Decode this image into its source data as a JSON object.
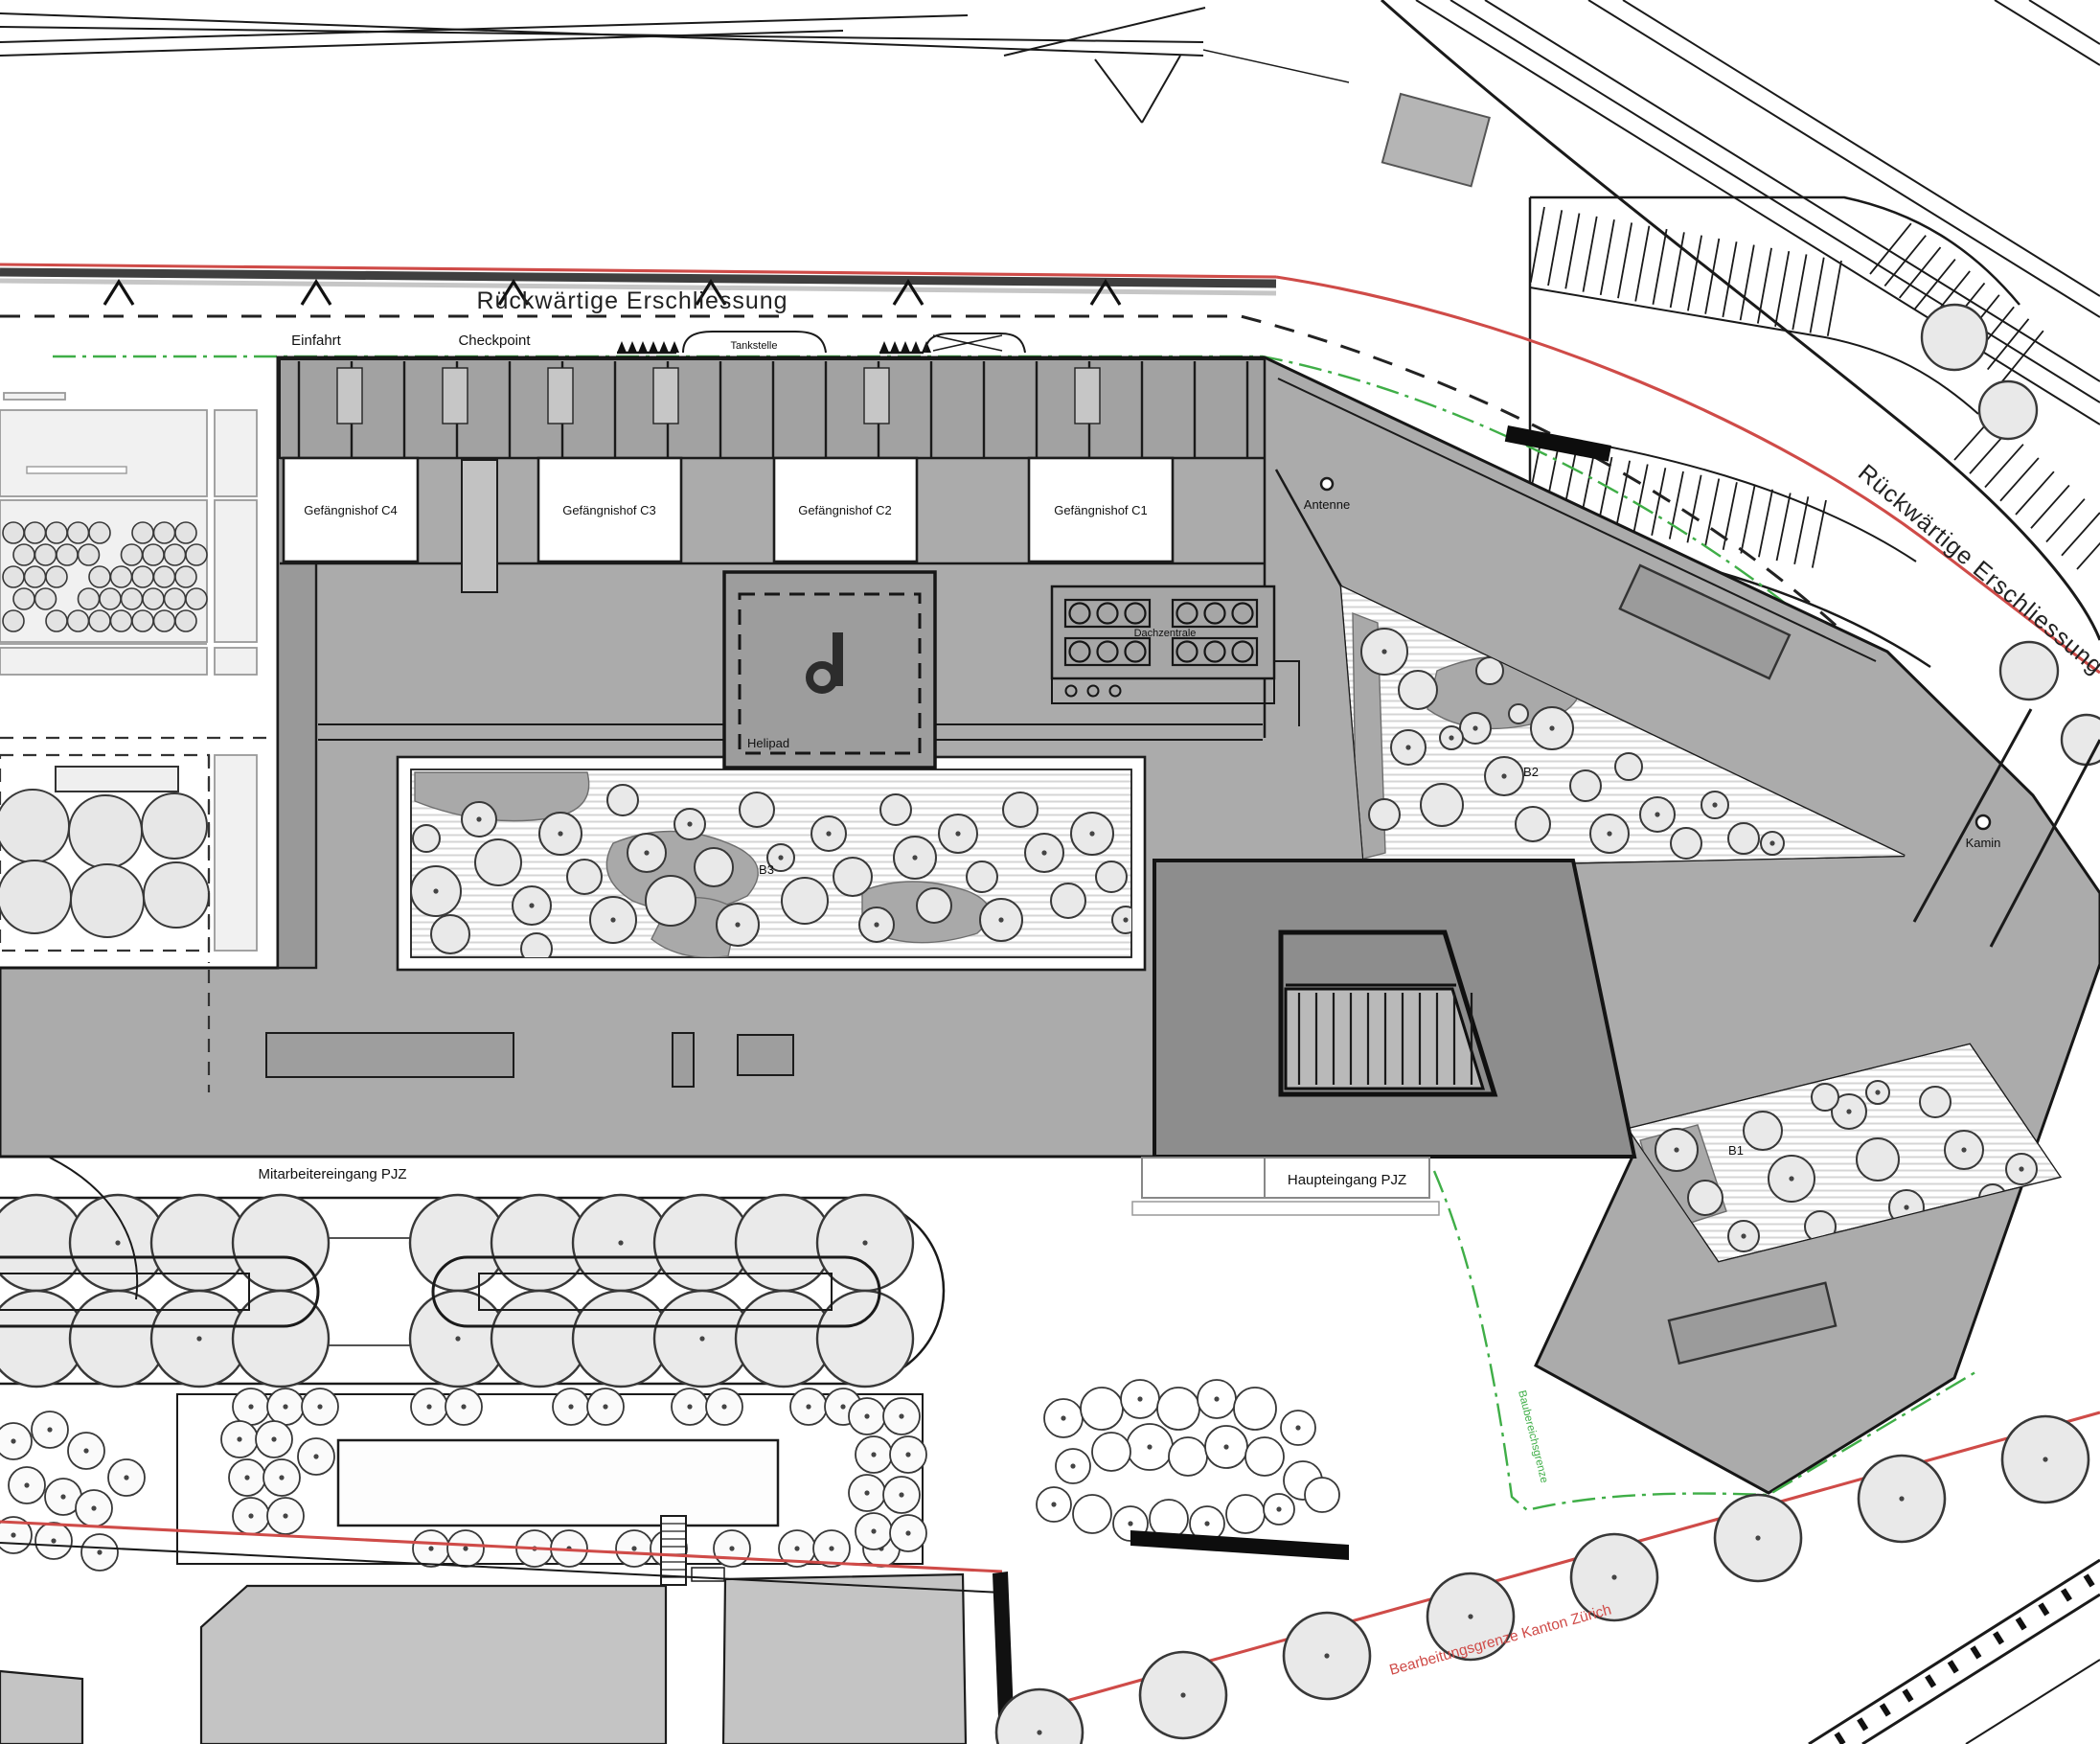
{
  "site_plan": {
    "roads": {
      "rear_access_top": "Rückwärtige Erschliessung",
      "rear_access_right": "Rückwärtige Erschliessung"
    },
    "access": {
      "einfahrt": "Einfahrt",
      "checkpoint": "Checkpoint",
      "tankstelle": "Tankstelle"
    },
    "prison_courtyards": {
      "c4": "Gefängnishof C4",
      "c3": "Gefängnishof C3",
      "c2": "Gefängnishof C2",
      "c1": "Gefängnishof C1"
    },
    "garden_courtyards": {
      "b1": "B1",
      "b2": "B2",
      "b3": "B3"
    },
    "roof_elements": {
      "antenne": "Antenne",
      "dachzentrale": "Dachzentrale",
      "helipad": "Helipad",
      "kamin": "Kamin"
    },
    "entrances": {
      "mitarbeitereingang": "Mitarbeitereingang PJZ",
      "haupteingang": "Haupteingang PJZ"
    },
    "boundaries": {
      "red_label": "Bearbeitungsgrenze Kanton Zürich",
      "green_label": "Baubereichsgrenze"
    },
    "colors": {
      "boundary_red": "#cf4b48",
      "boundary_green": "#3fae47",
      "roof_gray": "#ababab",
      "roof_dark": "#8d8d8d",
      "comb_gray": "#a2a2a2",
      "neighbor_gray": "#c4c4c4",
      "tree_fill": "#e9e9e9",
      "line_black": "#1a1a1a"
    }
  }
}
